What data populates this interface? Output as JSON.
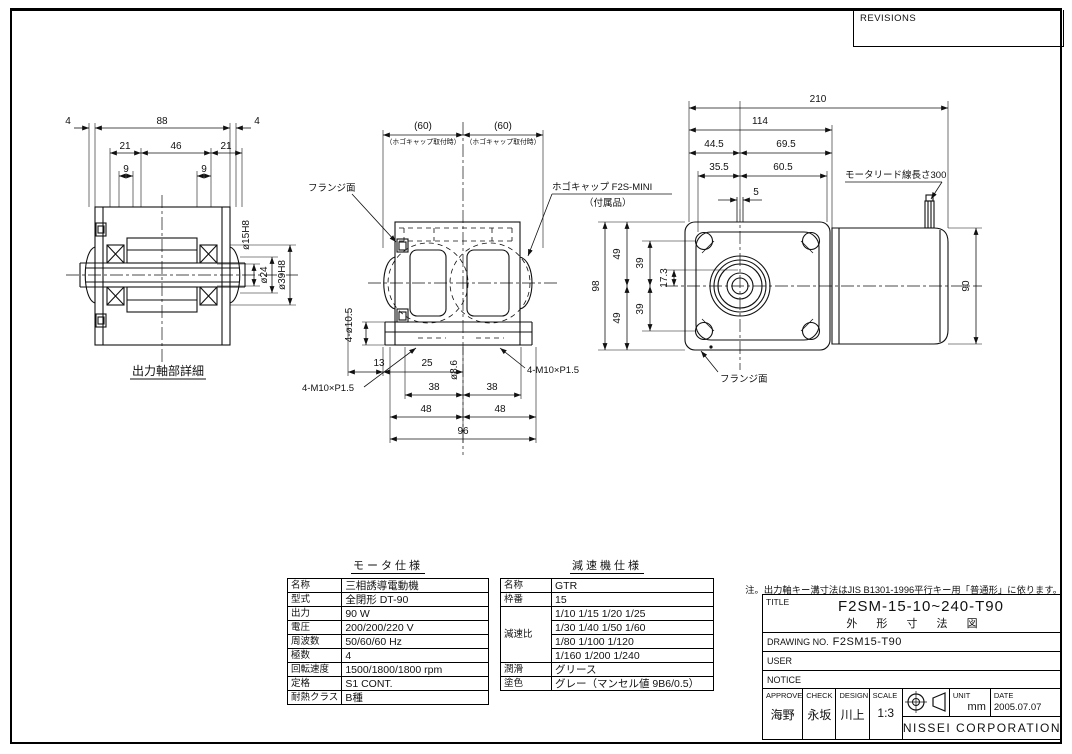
{
  "revisions": {
    "label": "REVISIONS"
  },
  "note": "注。出力軸キー溝寸法はJIS B1301-1996平行キー用「普通形」に依ります。",
  "views": {
    "shaft": {
      "caption": "出力軸部詳細",
      "d4a": "4",
      "d88": "88",
      "d4b": "4",
      "d21a": "21",
      "d46": "46",
      "d21b": "21",
      "d9a": "9",
      "d9b": "9",
      "dia15": "ø15H8",
      "dia24": "ø24",
      "dia39": "ø39H8"
    },
    "front": {
      "d60a": "(60)",
      "d60b": "(60)",
      "cap_note": "（ホゴキャップ取付時）",
      "flange_label": "フランジ面",
      "cap_label": "ホゴキャップ F2S-MINI",
      "cap_label2": "（付属品）",
      "d4dia": "4-ø10.5",
      "d13": "13",
      "d25": "25",
      "dia86": "ø8.6",
      "d38a": "38",
      "d38b": "38",
      "d48a": "48",
      "d48b": "48",
      "d96": "96",
      "bolt_l": "4-M10×P1.5",
      "bolt_r": "4-M10×P1.5"
    },
    "side": {
      "d210": "210",
      "d114": "114",
      "d445": "44.5",
      "d695": "69.5",
      "d355": "35.5",
      "d605": "60.5",
      "d5": "5",
      "lead_label": "モータリード線長さ300",
      "d98": "98",
      "d49a": "49",
      "d49b": "49",
      "d39a": "39",
      "d39b": "39",
      "d173": "17.3",
      "d90": "90",
      "flange_label": "フランジ面"
    }
  },
  "motor_table": {
    "title": "モータ仕様",
    "rows": [
      {
        "k": "名称",
        "v": "三相誘導電動機"
      },
      {
        "k": "型式",
        "v": "全閉形 DT-90"
      },
      {
        "k": "出力",
        "v": "90 W"
      },
      {
        "k": "電圧",
        "v": "200/200/220 V"
      },
      {
        "k": "周波数",
        "v": "50/60/60 Hz"
      },
      {
        "k": "極数",
        "v": "4"
      },
      {
        "k": "回転速度",
        "v": "1500/1800/1800 rpm"
      },
      {
        "k": "定格",
        "v": "S1 CONT."
      },
      {
        "k": "耐熱クラス",
        "v": "B種"
      }
    ]
  },
  "reducer_table": {
    "title": "減速機仕様",
    "name_k": "名称",
    "name_v": "GTR",
    "frame_k": "枠番",
    "frame_v": "15",
    "ratio_k": "減速比",
    "ratio_lines": [
      "1/10 1/15 1/20 1/25",
      "1/30 1/40 1/50 1/60",
      "1/80 1/100 1/120",
      "1/160 1/200 1/240"
    ],
    "lube_k": "潤滑",
    "lube_v": "グリース",
    "paint_k": "塗色",
    "paint_v": "グレー（マンセル値 9B6/0.5）"
  },
  "title_block": {
    "title_label": "TITLE",
    "title_line1": "F2SM-15-10~240-T90",
    "title_line2": "外 形 寸 法 図",
    "drawing_no_label": "DRAWING NO.",
    "drawing_no_value": "F2SM15-T90",
    "user_label": "USER",
    "notice_label": "NOTICE",
    "approve_label": "APPROVE",
    "approve_value": "海野",
    "check_label": "CHECK",
    "check_value": "永坂",
    "design_label": "DESIGN",
    "design_value": "川上",
    "scale_label": "SCALE",
    "scale_value": "1:3",
    "unit_label": "UNIT",
    "unit_value": "mm",
    "date_label": "DATE",
    "date_value": "2005.07.07",
    "company": "NISSEI CORPORATION"
  }
}
